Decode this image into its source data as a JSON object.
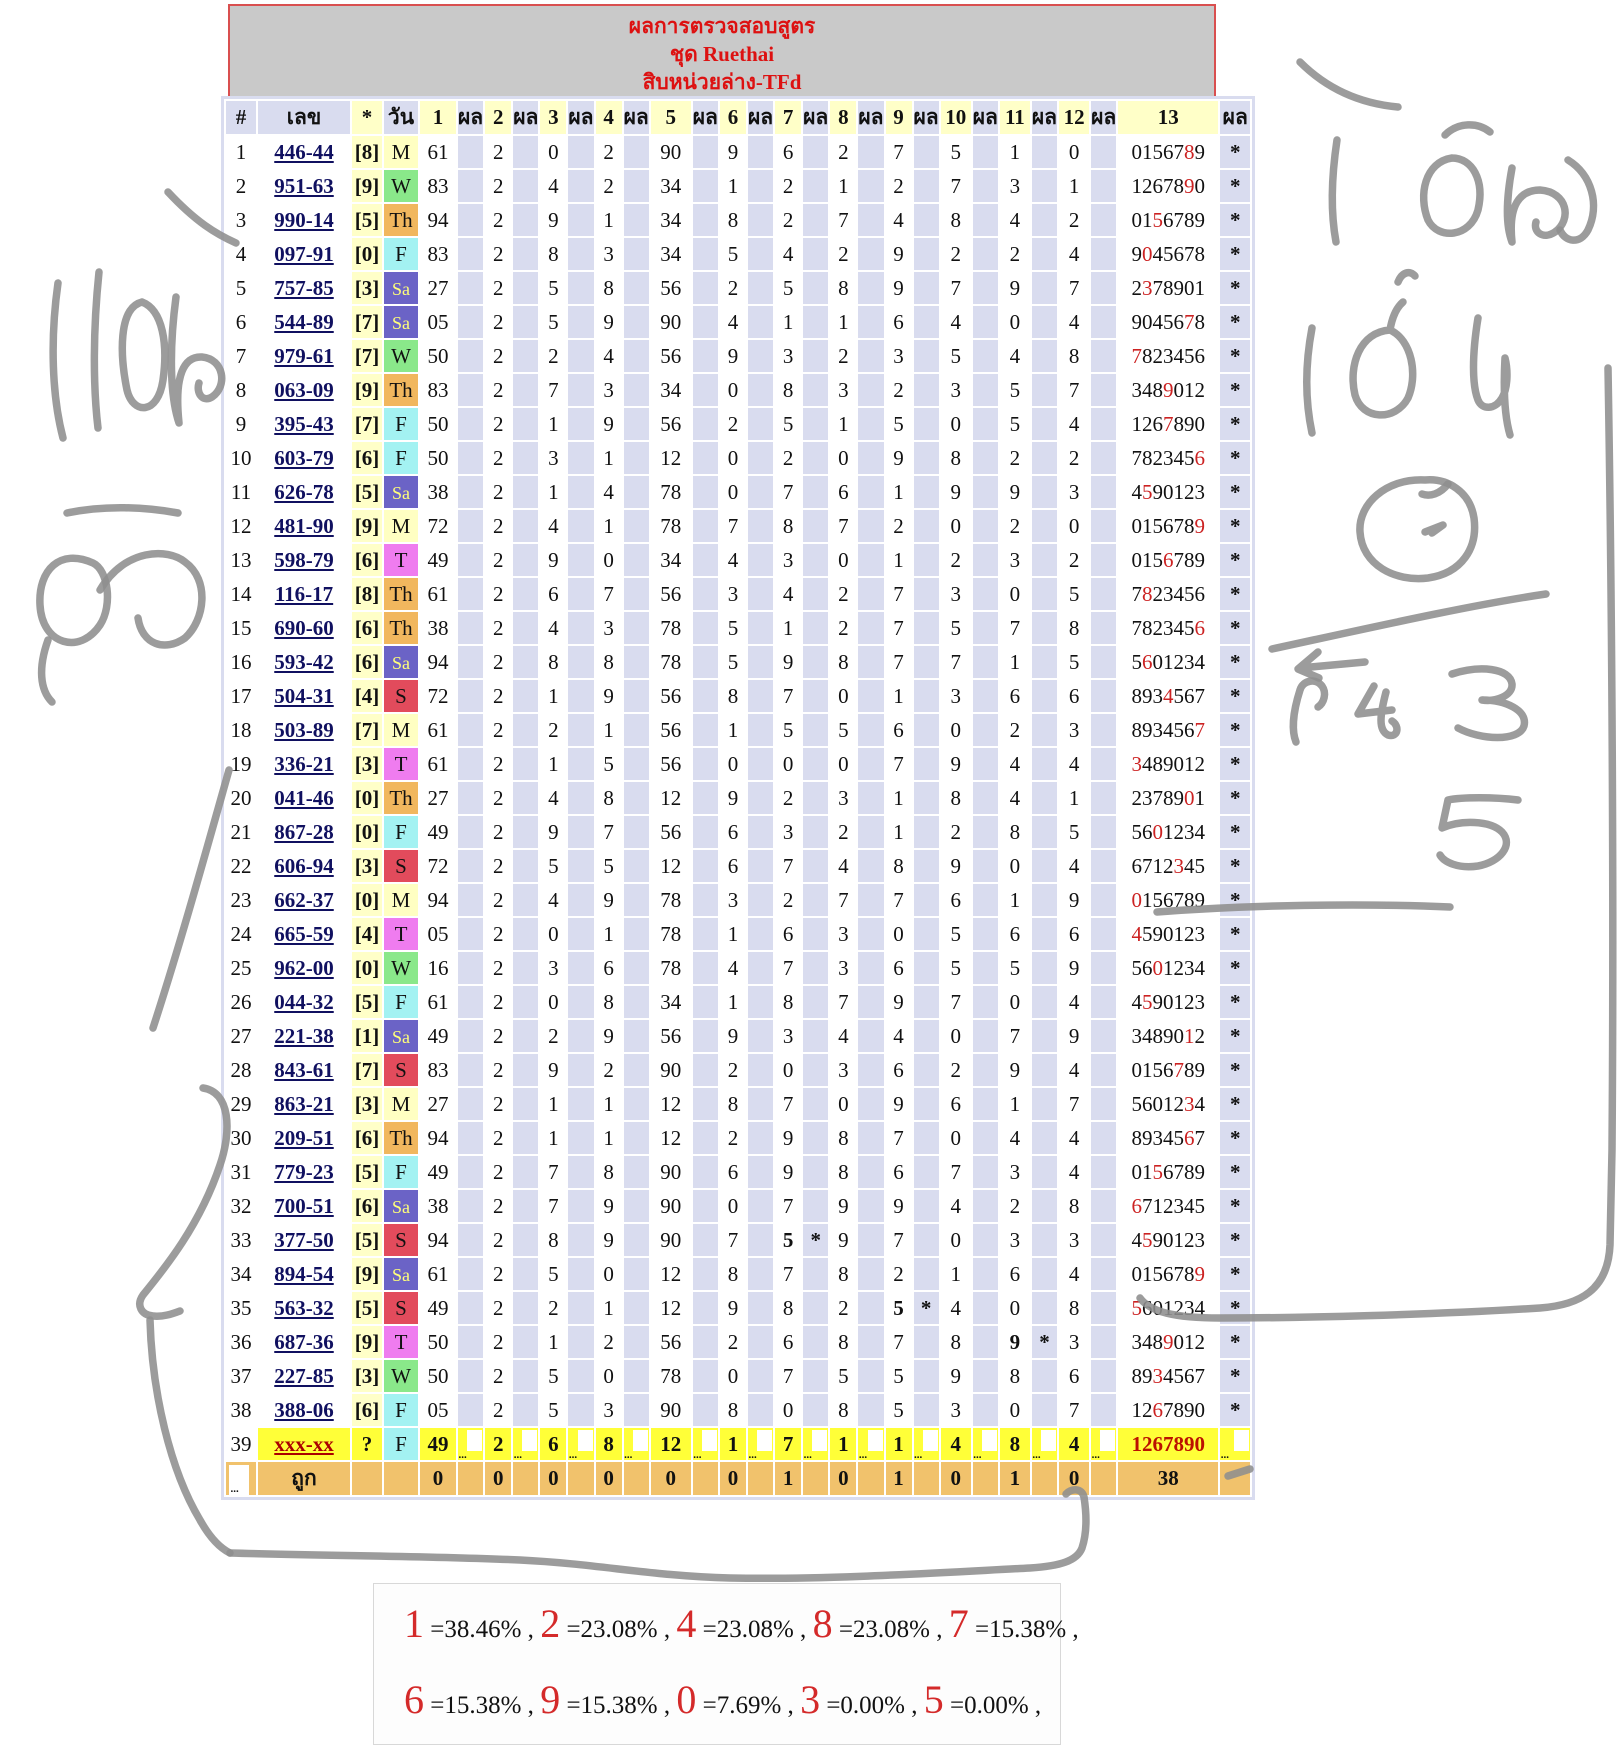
{
  "title": {
    "line1": "ผลการตรวจสอบสูตร",
    "line2": "ชุด Ruethai",
    "line3": "สิบหน่วยล่าง-TFd"
  },
  "columns": {
    "index": "#",
    "number": "เลข",
    "star": "*",
    "day": "วัน",
    "result": "ผล",
    "numbered": [
      "1",
      "2",
      "3",
      "4",
      "5",
      "6",
      "7",
      "8",
      "9",
      "10",
      "11",
      "12",
      "13"
    ]
  },
  "colors": {
    "lavender": "#d9dcef",
    "pale_yellow": "#ffffc8",
    "row39_yellow": "#ffff38",
    "footer_orange": "#f1c26c",
    "title_gray": "#c9c9c9",
    "title_red": "#dd1111",
    "magenta": "#cc22cc",
    "navy": "#1a1a8a",
    "hit_red": "#cc2222",
    "annotation_gray": "#8e8e8e",
    "day_colors": {
      "M": "#ffffc2",
      "T": "#ef7cef",
      "W": "#8ae88a",
      "Th": "#f1b75e",
      "F": "#a3f2f2",
      "Sa": "#6b63c6",
      "S": "#e24b5c"
    },
    "sa_text": "#ffff7a"
  },
  "rows": [
    {
      "i": "1",
      "num": "446-44",
      "b": "[8]",
      "day": "M",
      "v": [
        "61",
        "2",
        "0",
        "2",
        "90",
        "9",
        "6",
        "2",
        "7",
        "5",
        "1",
        "0"
      ],
      "t": "0156789",
      "r": 5
    },
    {
      "i": "2",
      "num": "951-63",
      "b": "[9]",
      "day": "W",
      "v": [
        "83",
        "2",
        "4",
        "2",
        "34",
        "1",
        "2",
        "1",
        "2",
        "7",
        "3",
        "1"
      ],
      "t": "1267890",
      "r": 5
    },
    {
      "i": "3",
      "num": "990-14",
      "b": "[5]",
      "day": "Th",
      "v": [
        "94",
        "2",
        "9",
        "1",
        "34",
        "8",
        "2",
        "7",
        "4",
        "8",
        "4",
        "2"
      ],
      "t": "0156789",
      "r": 2
    },
    {
      "i": "4",
      "num": "097-91",
      "b": "[0]",
      "day": "F",
      "v": [
        "83",
        "2",
        "8",
        "3",
        "34",
        "5",
        "4",
        "2",
        "9",
        "2",
        "2",
        "4"
      ],
      "t": "9045678",
      "r": 1
    },
    {
      "i": "5",
      "num": "757-85",
      "b": "[3]",
      "day": "Sa",
      "v": [
        "27",
        "2",
        "5",
        "8",
        "56",
        "2",
        "5",
        "8",
        "9",
        "7",
        "9",
        "7"
      ],
      "t": "2378901",
      "r": 1
    },
    {
      "i": "6",
      "num": "544-89",
      "b": "[7]",
      "day": "Sa",
      "v": [
        "05",
        "2",
        "5",
        "9",
        "90",
        "4",
        "1",
        "1",
        "6",
        "4",
        "0",
        "4"
      ],
      "t": "9045678",
      "r": 5
    },
    {
      "i": "7",
      "num": "979-61",
      "b": "[7]",
      "day": "W",
      "v": [
        "50",
        "2",
        "2",
        "4",
        "56",
        "9",
        "3",
        "2",
        "3",
        "5",
        "4",
        "8"
      ],
      "t": "7823456",
      "r": 0
    },
    {
      "i": "8",
      "num": "063-09",
      "b": "[9]",
      "day": "Th",
      "v": [
        "83",
        "2",
        "7",
        "3",
        "34",
        "0",
        "8",
        "3",
        "2",
        "3",
        "5",
        "7"
      ],
      "t": "3489012",
      "r": 3
    },
    {
      "i": "9",
      "num": "395-43",
      "b": "[7]",
      "day": "F",
      "v": [
        "50",
        "2",
        "1",
        "9",
        "56",
        "2",
        "5",
        "1",
        "5",
        "0",
        "5",
        "4"
      ],
      "t": "1267890",
      "r": 3
    },
    {
      "i": "10",
      "num": "603-79",
      "b": "[6]",
      "day": "F",
      "v": [
        "50",
        "2",
        "3",
        "1",
        "12",
        "0",
        "2",
        "0",
        "9",
        "8",
        "2",
        "2"
      ],
      "t": "7823456",
      "r": 6
    },
    {
      "i": "11",
      "num": "626-78",
      "b": "[5]",
      "day": "Sa",
      "v": [
        "38",
        "2",
        "1",
        "4",
        "78",
        "0",
        "7",
        "6",
        "1",
        "9",
        "9",
        "3"
      ],
      "t": "4590123",
      "r": 1
    },
    {
      "i": "12",
      "num": "481-90",
      "b": "[9]",
      "day": "M",
      "v": [
        "72",
        "2",
        "4",
        "1",
        "78",
        "7",
        "8",
        "7",
        "2",
        "0",
        "2",
        "0"
      ],
      "t": "0156789",
      "r": 6
    },
    {
      "i": "13",
      "num": "598-79",
      "b": "[6]",
      "day": "T",
      "v": [
        "49",
        "2",
        "9",
        "0",
        "34",
        "4",
        "3",
        "0",
        "1",
        "2",
        "3",
        "2"
      ],
      "t": "0156789",
      "r": 3
    },
    {
      "i": "14",
      "num": "116-17",
      "b": "[8]",
      "day": "Th",
      "v": [
        "61",
        "2",
        "6",
        "7",
        "56",
        "3",
        "4",
        "2",
        "7",
        "3",
        "0",
        "5"
      ],
      "t": "7823456",
      "r": 1
    },
    {
      "i": "15",
      "num": "690-60",
      "b": "[6]",
      "day": "Th",
      "v": [
        "38",
        "2",
        "4",
        "3",
        "78",
        "5",
        "1",
        "2",
        "7",
        "5",
        "7",
        "8"
      ],
      "t": "7823456",
      "r": 6
    },
    {
      "i": "16",
      "num": "593-42",
      "b": "[6]",
      "day": "Sa",
      "v": [
        "94",
        "2",
        "8",
        "8",
        "78",
        "5",
        "9",
        "8",
        "7",
        "7",
        "1",
        "5"
      ],
      "t": "5601234",
      "r": 1
    },
    {
      "i": "17",
      "num": "504-31",
      "b": "[4]",
      "day": "S",
      "v": [
        "72",
        "2",
        "1",
        "9",
        "56",
        "8",
        "7",
        "0",
        "1",
        "3",
        "6",
        "6"
      ],
      "t": "8934567",
      "r": 3
    },
    {
      "i": "18",
      "num": "503-89",
      "b": "[7]",
      "day": "M",
      "v": [
        "61",
        "2",
        "2",
        "1",
        "56",
        "1",
        "5",
        "5",
        "6",
        "0",
        "2",
        "3"
      ],
      "t": "8934567",
      "r": 6
    },
    {
      "i": "19",
      "num": "336-21",
      "b": "[3]",
      "day": "T",
      "v": [
        "61",
        "2",
        "1",
        "5",
        "56",
        "0",
        "0",
        "0",
        "7",
        "9",
        "4",
        "4"
      ],
      "t": "3489012",
      "r": 0
    },
    {
      "i": "20",
      "num": "041-46",
      "b": "[0]",
      "day": "Th",
      "v": [
        "27",
        "2",
        "4",
        "8",
        "12",
        "9",
        "2",
        "3",
        "1",
        "8",
        "4",
        "1"
      ],
      "t": "2378901",
      "r": 5
    },
    {
      "i": "21",
      "num": "867-28",
      "b": "[0]",
      "day": "F",
      "v": [
        "49",
        "2",
        "9",
        "7",
        "56",
        "6",
        "3",
        "2",
        "1",
        "2",
        "8",
        "5"
      ],
      "t": "5601234",
      "r": 2
    },
    {
      "i": "22",
      "num": "606-94",
      "b": "[3]",
      "day": "S",
      "v": [
        "72",
        "2",
        "5",
        "5",
        "12",
        "6",
        "7",
        "4",
        "8",
        "9",
        "0",
        "4"
      ],
      "t": "6712345",
      "r": 4
    },
    {
      "i": "23",
      "num": "662-37",
      "b": "[0]",
      "day": "M",
      "v": [
        "94",
        "2",
        "4",
        "9",
        "78",
        "3",
        "2",
        "7",
        "7",
        "6",
        "1",
        "9"
      ],
      "t": "0156789",
      "r": 0
    },
    {
      "i": "24",
      "num": "665-59",
      "b": "[4]",
      "day": "T",
      "v": [
        "05",
        "2",
        "0",
        "1",
        "78",
        "1",
        "6",
        "3",
        "0",
        "5",
        "6",
        "6"
      ],
      "t": "4590123",
      "r": 0
    },
    {
      "i": "25",
      "num": "962-00",
      "b": "[0]",
      "day": "W",
      "v": [
        "16",
        "2",
        "3",
        "6",
        "78",
        "4",
        "7",
        "3",
        "6",
        "5",
        "5",
        "9"
      ],
      "t": "5601234",
      "r": 2
    },
    {
      "i": "26",
      "num": "044-32",
      "b": "[5]",
      "day": "F",
      "v": [
        "61",
        "2",
        "0",
        "8",
        "34",
        "1",
        "8",
        "7",
        "9",
        "7",
        "0",
        "4"
      ],
      "t": "4590123",
      "r": 1
    },
    {
      "i": "27",
      "num": "221-38",
      "b": "[1]",
      "day": "Sa",
      "v": [
        "49",
        "2",
        "2",
        "9",
        "56",
        "9",
        "3",
        "4",
        "4",
        "0",
        "7",
        "9"
      ],
      "t": "3489012",
      "r": 5
    },
    {
      "i": "28",
      "num": "843-61",
      "b": "[7]",
      "day": "S",
      "v": [
        "83",
        "2",
        "9",
        "2",
        "90",
        "2",
        "0",
        "3",
        "6",
        "2",
        "9",
        "4"
      ],
      "t": "0156789",
      "r": 4
    },
    {
      "i": "29",
      "num": "863-21",
      "b": "[3]",
      "day": "M",
      "v": [
        "27",
        "2",
        "1",
        "1",
        "12",
        "8",
        "7",
        "0",
        "9",
        "6",
        "1",
        "7"
      ],
      "t": "5601234",
      "r": 5
    },
    {
      "i": "30",
      "num": "209-51",
      "b": "[6]",
      "day": "Th",
      "v": [
        "94",
        "2",
        "1",
        "1",
        "12",
        "2",
        "9",
        "8",
        "7",
        "0",
        "4",
        "4"
      ],
      "t": "8934567",
      "r": 5
    },
    {
      "i": "31",
      "num": "779-23",
      "b": "[5]",
      "day": "F",
      "v": [
        "49",
        "2",
        "7",
        "8",
        "90",
        "6",
        "9",
        "8",
        "6",
        "7",
        "3",
        "4"
      ],
      "t": "0156789",
      "r": 2
    },
    {
      "i": "32",
      "num": "700-51",
      "b": "[6]",
      "day": "Sa",
      "v": [
        "38",
        "2",
        "7",
        "9",
        "90",
        "0",
        "7",
        "9",
        "9",
        "4",
        "2",
        "8"
      ],
      "t": "6712345",
      "r": 0
    },
    {
      "i": "33",
      "num": "377-50",
      "b": "[5]",
      "day": "S",
      "v": [
        "94",
        "2",
        "8",
        "9",
        "90",
        "7",
        "5",
        "9",
        "7",
        "0",
        "3",
        "3"
      ],
      "t": "4590123",
      "r": 1,
      "hit": 6
    },
    {
      "i": "34",
      "num": "894-54",
      "b": "[9]",
      "day": "Sa",
      "v": [
        "61",
        "2",
        "5",
        "0",
        "12",
        "8",
        "7",
        "8",
        "2",
        "1",
        "6",
        "4"
      ],
      "t": "0156789",
      "r": 6
    },
    {
      "i": "35",
      "num": "563-32",
      "b": "[5]",
      "day": "S",
      "v": [
        "49",
        "2",
        "2",
        "1",
        "12",
        "9",
        "8",
        "2",
        "5",
        "4",
        "0",
        "8"
      ],
      "t": "5601234",
      "r": 0,
      "hit": 8
    },
    {
      "i": "36",
      "num": "687-36",
      "b": "[9]",
      "day": "T",
      "v": [
        "50",
        "2",
        "1",
        "2",
        "56",
        "2",
        "6",
        "8",
        "7",
        "8",
        "9",
        "3"
      ],
      "t": "3489012",
      "r": 3,
      "hit": 10
    },
    {
      "i": "37",
      "num": "227-85",
      "b": "[3]",
      "day": "W",
      "v": [
        "50",
        "2",
        "5",
        "0",
        "78",
        "0",
        "7",
        "5",
        "5",
        "9",
        "8",
        "6"
      ],
      "t": "8934567",
      "r": 2
    },
    {
      "i": "38",
      "num": "388-06",
      "b": "[6]",
      "day": "F",
      "v": [
        "05",
        "2",
        "5",
        "3",
        "90",
        "8",
        "0",
        "8",
        "5",
        "3",
        "0",
        "7"
      ],
      "t": "1267890",
      "r": 2
    },
    {
      "i": "39",
      "num": "xxx-xx",
      "b": "?",
      "day": "F",
      "v": [
        "49",
        "2",
        "6",
        "8",
        "12",
        "1",
        "7",
        "1",
        "1",
        "4",
        "8",
        "4"
      ],
      "t": "1267890",
      "r": "all",
      "dots": "..."
    }
  ],
  "result_star": "*",
  "footer": {
    "first": "...",
    "label": "ถูก",
    "values": [
      "0",
      "0",
      "0",
      "0",
      "0",
      "0",
      "1",
      "0",
      "1",
      "0",
      "1",
      "0"
    ],
    "total": "38"
  },
  "summary": {
    "lines": [
      [
        {
          "digit": "1",
          "pct": "=38.46%"
        },
        {
          "digit": "2",
          "pct": "=23.08%"
        },
        {
          "digit": "4",
          "pct": "=23.08%"
        },
        {
          "digit": "8",
          "pct": "=23.08%"
        },
        {
          "digit": "7",
          "pct": "=15.38%"
        }
      ],
      [
        {
          "digit": "6",
          "pct": "=15.38%"
        },
        {
          "digit": "9",
          "pct": "=15.38%"
        },
        {
          "digit": "0",
          "pct": "=7.69%"
        },
        {
          "digit": "3",
          "pct": "=0.00%"
        },
        {
          "digit": "5",
          "pct": "=0.00%"
        }
      ]
    ],
    "separator": " , "
  },
  "annotations": {
    "left_word_top": "แต้ม",
    "left_word_bottom": "ตัว",
    "left_marks": [
      "1",
      "2"
    ],
    "right_word_top": "แต้ม",
    "right_word_mid": "เด่น",
    "right_small_note": "กิ๋",
    "right_digits": [
      "3",
      "5"
    ]
  }
}
